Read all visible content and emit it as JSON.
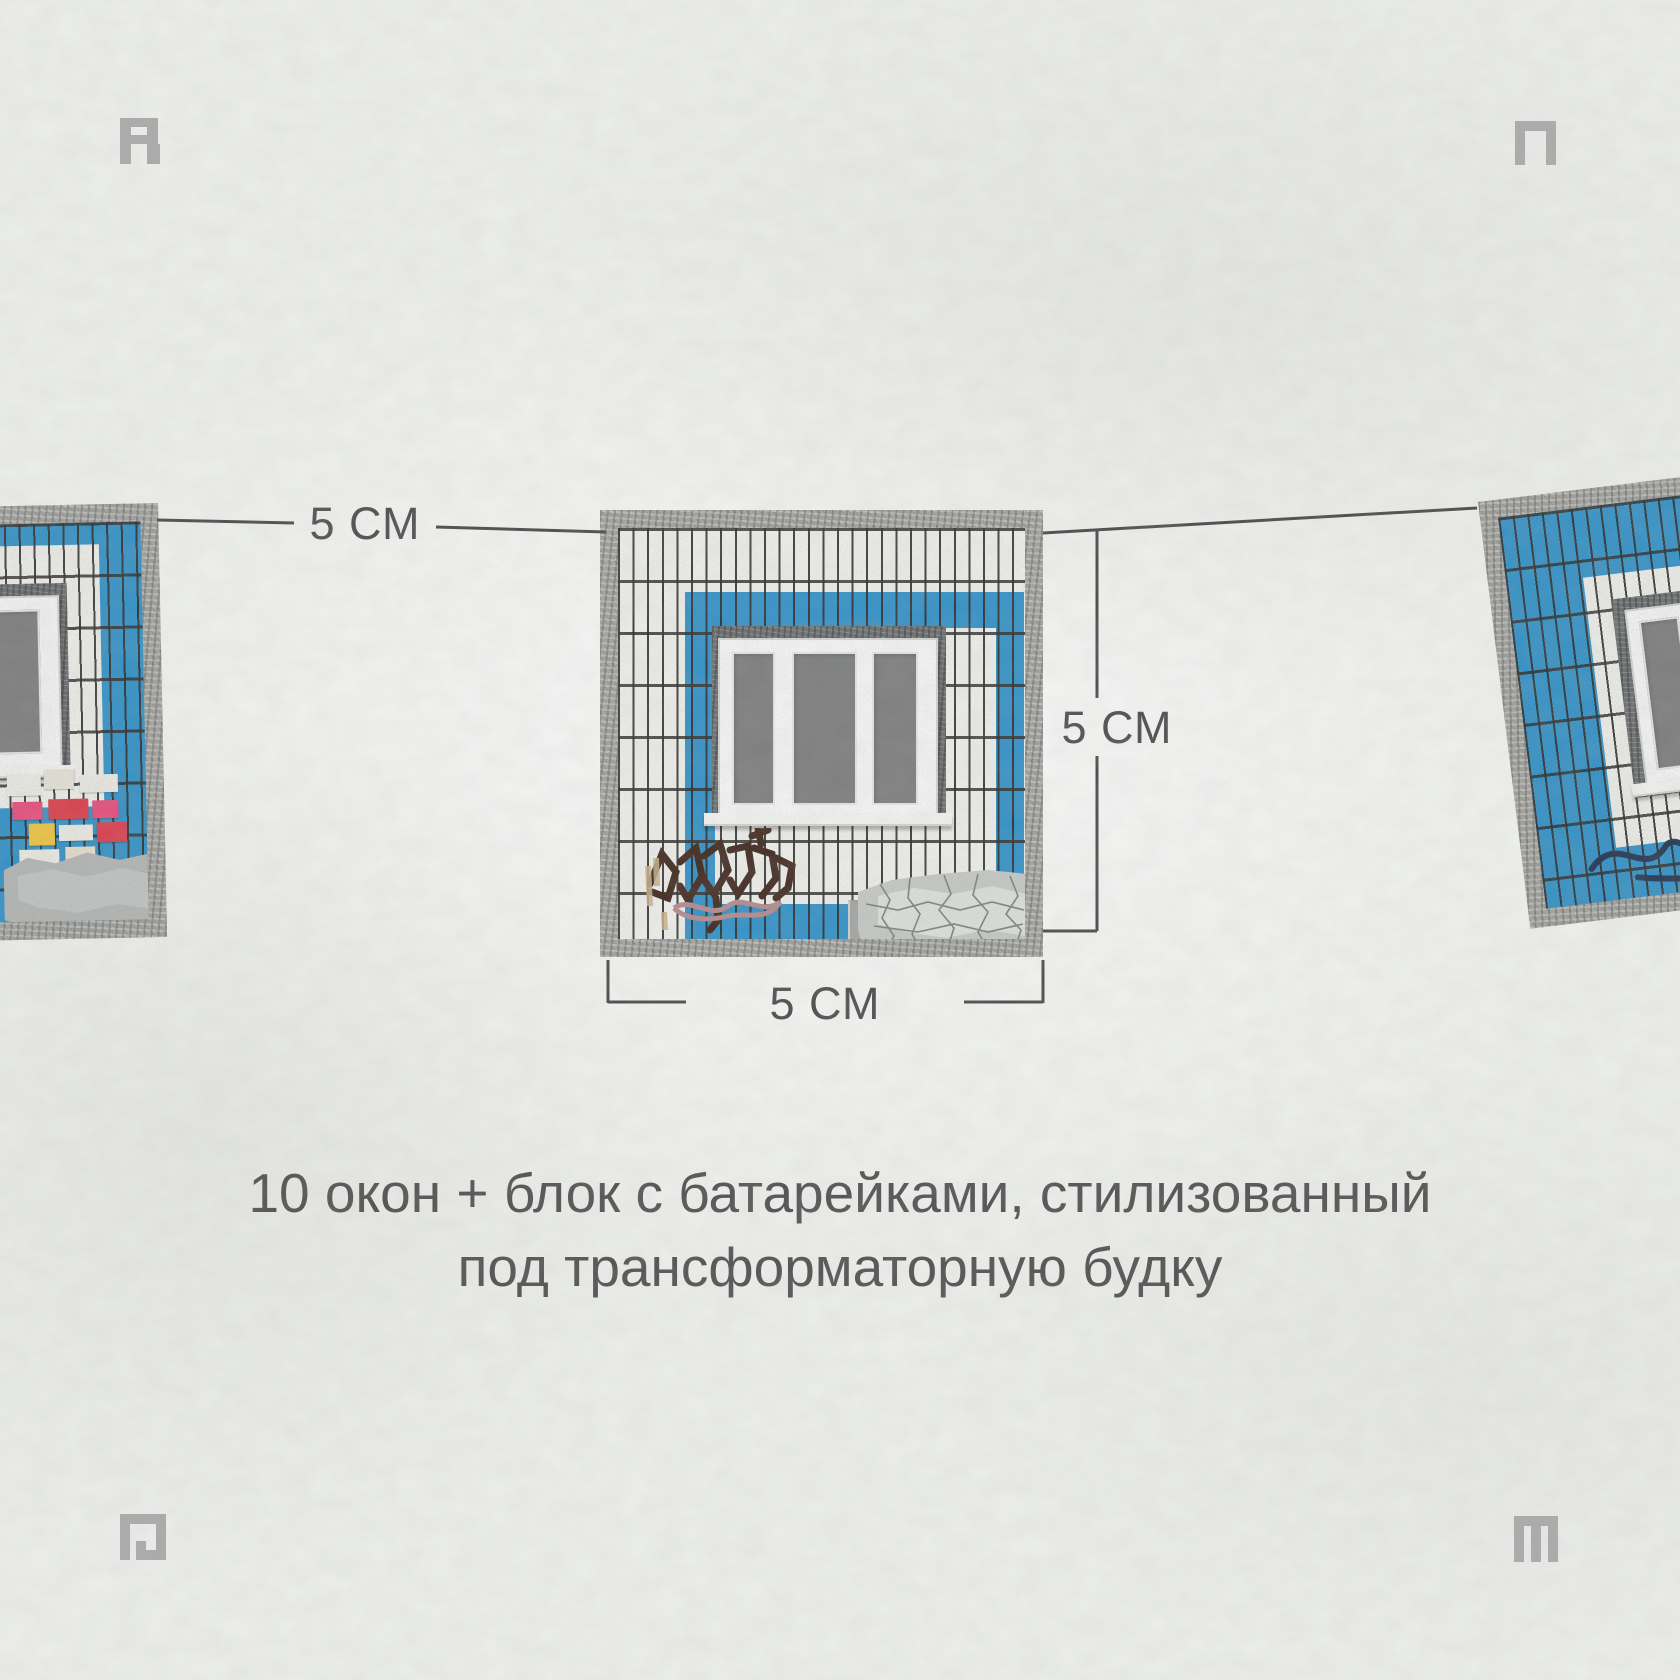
{
  "dimension_labels": {
    "top": "5 СМ",
    "right": "5 СМ",
    "bottom": "5 СМ"
  },
  "caption": {
    "line1": "10 окон + блок с батарейками, стилизованный",
    "line2": "под трансформаторную будку"
  },
  "corner_marks": {
    "top_left": "R",
    "top_right": "П",
    "bottom_left": "Р",
    "bottom_right": "М"
  },
  "panels": [
    {
      "id": "left",
      "visible": "partial",
      "features": [
        "blue tiles",
        "white window surround",
        "three-pane window (cut off)",
        "posters and stickers",
        "gray paint patch"
      ]
    },
    {
      "id": "center",
      "visible": "full",
      "features": [
        "white tiles",
        "blue tile ring",
        "concrete recess",
        "three-pane window",
        "brown graffiti tag",
        "peeling paint patch",
        "drain pipe"
      ]
    },
    {
      "id": "right",
      "visible": "partial",
      "tilt": "slight",
      "features": [
        "blue tiles",
        "white inner ring",
        "three-pane window (cut off)",
        "navy graffiti tag"
      ]
    }
  ],
  "colors": {
    "wall": "#eef0ed",
    "tile_blue": "#2d93cd",
    "tile_white": "#f5f5f2",
    "grout": "#29282 6",
    "concrete_border": "#a5a5a2",
    "window_recess": "#686c6e",
    "window_glass": "#7c7e7d",
    "dimension_line": "#474747",
    "text": "#4e4e4e",
    "corner_mark": "#a4a4a4"
  }
}
